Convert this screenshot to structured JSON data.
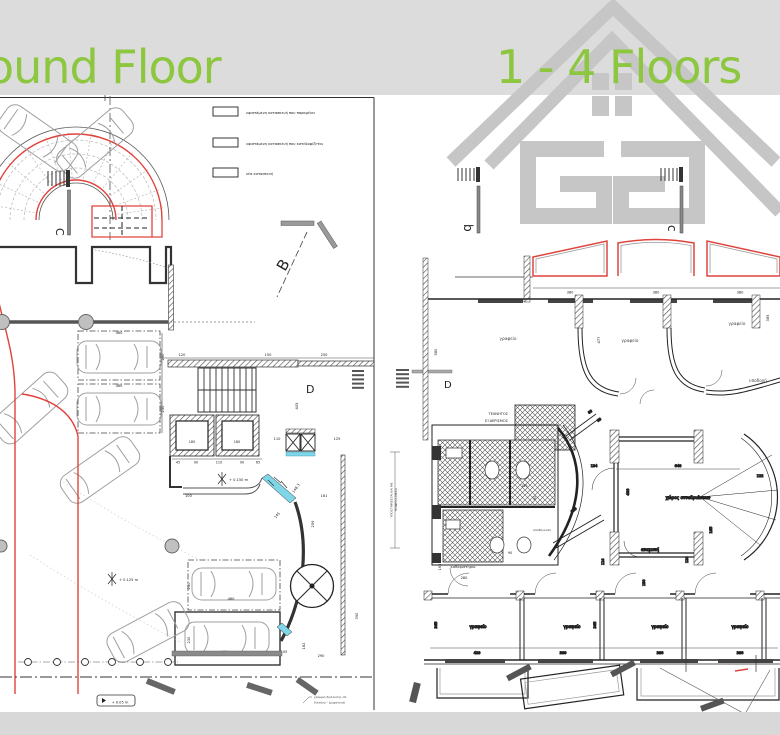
{
  "header": {
    "left_title": "ound Floor",
    "right_title": "1 - 4 Floors"
  },
  "colors": {
    "title_green": "#8dc63f",
    "band_gray": "#dcdcdc",
    "logo_gray": "#c6c6c6",
    "red": "#e0433d",
    "cyan": "#7fd6e8"
  },
  "logo": {
    "name": "ag-house-logo"
  },
  "left_plan": {
    "legend": [
      "υφιστάμενη κατασκευή που παραμένει",
      "υφιστάμενη κατασκευή που κατεδαφίζεται",
      "νέα κατασκευή"
    ],
    "section_markers": {
      "c": "C",
      "b": "B",
      "d": "D"
    },
    "elevators": [
      "180",
      "180"
    ],
    "levels": [
      "+ 0.150  m",
      "+ 0.125  m",
      "+ 0.05 m"
    ],
    "dims": [
      "460",
      "460",
      "460",
      "460",
      "230",
      "230",
      "230",
      "230",
      "120",
      "150",
      "250",
      "110",
      "125",
      "45",
      "90",
      "110",
      "90",
      "65",
      "405",
      "100",
      "145",
      "161",
      "259",
      "290",
      "182",
      "105",
      "390",
      "148.3"
    ],
    "note_lines": [
      "γραμμή διέλευσης οδ.",
      "δικτύου - (μηχανικά)"
    ]
  },
  "right_plan": {
    "section_markers": {
      "b": "b",
      "c": "c",
      "d": "D"
    },
    "rooms": {
      "office": "γραφείο",
      "reception": "υποδοχή",
      "meeting": "χώρος συνεδριάσεων",
      "waiting": "αναμονή",
      "cleaning": "καθαριστήριο",
      "storage": "αποθήκευση"
    },
    "vent_label_lines": [
      "ΤΕΧΝΗΤΟΣ",
      "ΕΞΑΕΡΙΣΜΟΣ"
    ],
    "side_note_lines": [
      "Ο ΕΞΑΕΡΙΣΜΟΣ ΤΟΥ ΧΩΡΟΥ",
      "ΥΠΟΣΤΗΡΙΖΕΤΑΙ ΚΑΙ ΜΕ",
      "ΤΕΧΝΗΤΑ ΜΕΣΑ"
    ],
    "dims": [
      "380",
      "380",
      "380",
      "580",
      "477",
      "385",
      "134",
      "640",
      "400",
      "122",
      "185",
      "80",
      "80",
      "155",
      "90",
      "90",
      "110",
      "120",
      "120",
      "165",
      "280",
      "420",
      "380",
      "380",
      "380",
      "365",
      "365",
      "130"
    ]
  }
}
